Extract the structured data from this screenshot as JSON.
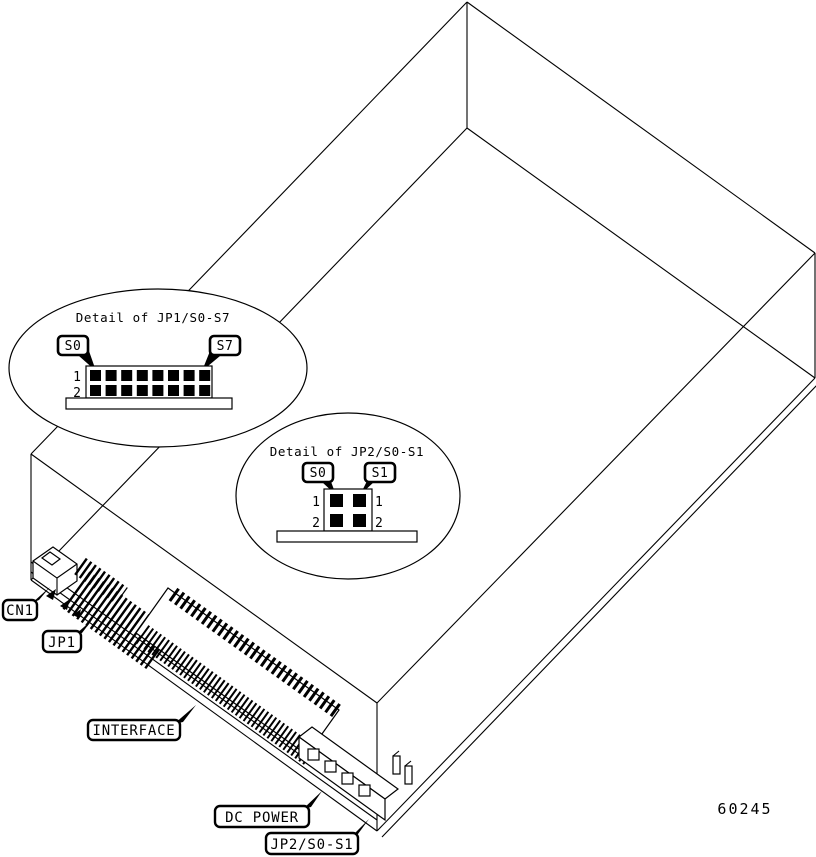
{
  "figure": {
    "number": "60245"
  },
  "detail_bubbles": [
    {
      "title": "Detail of JP1/S0-S7",
      "pin_labels": [
        "S0",
        "S7"
      ],
      "row_labels": [
        "1",
        "2"
      ],
      "pin_rows": 2,
      "pin_cols": 8
    },
    {
      "title": "Detail of JP2/S0-S1",
      "pin_labels": [
        "S0",
        "S1"
      ],
      "row_labels": [
        "1",
        "2"
      ],
      "pin_rows": 2,
      "pin_cols": 2
    }
  ],
  "component_labels": [
    {
      "text": "CN1"
    },
    {
      "text": "JP1"
    },
    {
      "text": "INTERFACE"
    },
    {
      "text": "DC POWER"
    },
    {
      "text": "JP2/S0-S1"
    }
  ],
  "colors": {
    "line": "#000000",
    "background": "#ffffff"
  }
}
